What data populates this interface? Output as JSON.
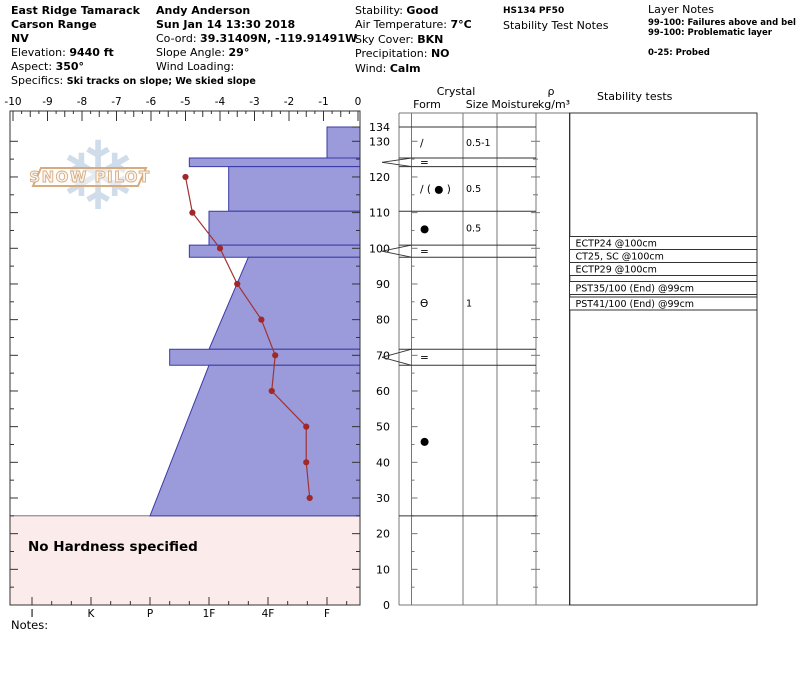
{
  "header": {
    "location": {
      "name": "East Ridge Tamarack",
      "range": "Carson Range",
      "state": "NV",
      "elevation_label": "Elevation: ",
      "elevation": "9440 ft",
      "aspect_label": "Aspect: ",
      "aspect": "350°",
      "specifics_label": "Specifics: ",
      "specifics": "Ski tracks on slope; We skied slope"
    },
    "observer": {
      "name": "Andy Anderson",
      "datetime": "Sun Jan 14 13:30 2018",
      "coord_label": "Co-ord: ",
      "coord": "39.31409N, -119.91491W",
      "slope_label": "Slope Angle: ",
      "slope": "29°",
      "wind_loading_label": "Wind Loading:"
    },
    "conditions": {
      "stability_label": "Stability: ",
      "stability": "Good",
      "air_temp_label": "Air Temperature: ",
      "air_temp": "7°C",
      "sky_label": "Sky Cover: ",
      "sky": "BKN",
      "precip_label": "Precipitation: ",
      "precip": "NO",
      "wind_label": "Wind: ",
      "wind": "Calm"
    },
    "summary": {
      "hs_line": "HS134 PF50",
      "test_notes_title": "Stability Test Notes"
    },
    "layer_notes": {
      "title": "Layer Notes",
      "lines": [
        "99-100: Failures above and bel",
        "99-100: Problematic layer",
        "0-25: Probed"
      ]
    }
  },
  "logo": {
    "text": "SNOW PILOT",
    "snowflake_icon": "❄",
    "flake_color": "#cfdce9",
    "band_color": "#d7ab80"
  },
  "notes_label": "Notes:",
  "panel_headers": {
    "crystal": "Crystal",
    "form": "Form",
    "size": "Size",
    "moisture": "Moisture",
    "rho": "ρ",
    "rho_units": "kg/m³",
    "stability": "Stability tests"
  },
  "chart_data": {
    "type": "snow-profile",
    "temp_axis": {
      "unit": "°C",
      "min": -10,
      "max": 0,
      "tick_step": 1
    },
    "hardness_axis": {
      "categories": [
        "I",
        "K",
        "P",
        "1F",
        "4F",
        "F"
      ]
    },
    "depth_axis": {
      "unit": "cm",
      "snow_height": 134,
      "tick_labels": [
        134,
        130,
        120,
        110,
        100,
        90,
        80,
        70,
        60,
        50,
        40,
        30,
        20,
        10,
        0
      ]
    },
    "layers": [
      {
        "top": 134,
        "bottom": 125.3,
        "hardness_top": "F",
        "hardness_bottom": "F",
        "form": "∕",
        "size": "0.5-1",
        "thin": false
      },
      {
        "top": 125.3,
        "bottom": 122.9,
        "hardness_top": "1F+",
        "hardness_bottom": "1F+",
        "form": "=",
        "size": "",
        "thin": true
      },
      {
        "top": 122.9,
        "bottom": 110.4,
        "hardness_top": "1F-",
        "hardness_bottom": "1F-",
        "form": "∕ ( ● )",
        "size": "0.5",
        "thin": false
      },
      {
        "top": 110.4,
        "bottom": 100.9,
        "hardness_top": "1F",
        "hardness_bottom": "1F",
        "form": "●",
        "size": "0.5",
        "thin": false
      },
      {
        "top": 100.9,
        "bottom": 97.5,
        "hardness_top": "1F+",
        "hardness_bottom": "1F+",
        "form": "=",
        "size": "",
        "thin": true
      },
      {
        "top": 97.5,
        "bottom": 71.7,
        "hardness_top": "4F+",
        "hardness_bottom": "1F",
        "form": "Ɵ",
        "size": "1",
        "thin": false
      },
      {
        "top": 71.7,
        "bottom": 67.2,
        "hardness_top": "P-",
        "hardness_bottom": "P-",
        "form": "=",
        "size": "",
        "thin": true
      },
      {
        "top": 67.2,
        "bottom": 25,
        "hardness_top": "1F",
        "hardness_bottom": "P",
        "form": "●",
        "size": "",
        "thin": false
      }
    ],
    "no_hardness_region": {
      "top": 25,
      "bottom": 0,
      "label": "No Hardness specified"
    },
    "temperature_profile": [
      {
        "depth": 120,
        "temp_c": -5.0
      },
      {
        "depth": 110,
        "temp_c": -4.8
      },
      {
        "depth": 100,
        "temp_c": -4.0
      },
      {
        "depth": 90,
        "temp_c": -3.5
      },
      {
        "depth": 80,
        "temp_c": -2.8
      },
      {
        "depth": 70,
        "temp_c": -2.4
      },
      {
        "depth": 60,
        "temp_c": -2.5
      },
      {
        "depth": 50,
        "temp_c": -1.5
      },
      {
        "depth": 40,
        "temp_c": -1.5
      },
      {
        "depth": 30,
        "temp_c": -1.4
      }
    ],
    "stability_tests": [
      "ECTP24 @100cm",
      "CT25, SC @100cm",
      "ECTP29 @100cm",
      "PST35/100 (End) @99cm",
      "PST41/100 (End) @99cm"
    ],
    "colors": {
      "bar_fill": "#9b9bdb",
      "bar_border": "#3a3aa6",
      "temp_line": "#a03333",
      "temp_dot": "#a02828",
      "no_hardness_fill": "#fcebeb",
      "axis": "#333333",
      "grid": "#777777"
    }
  }
}
